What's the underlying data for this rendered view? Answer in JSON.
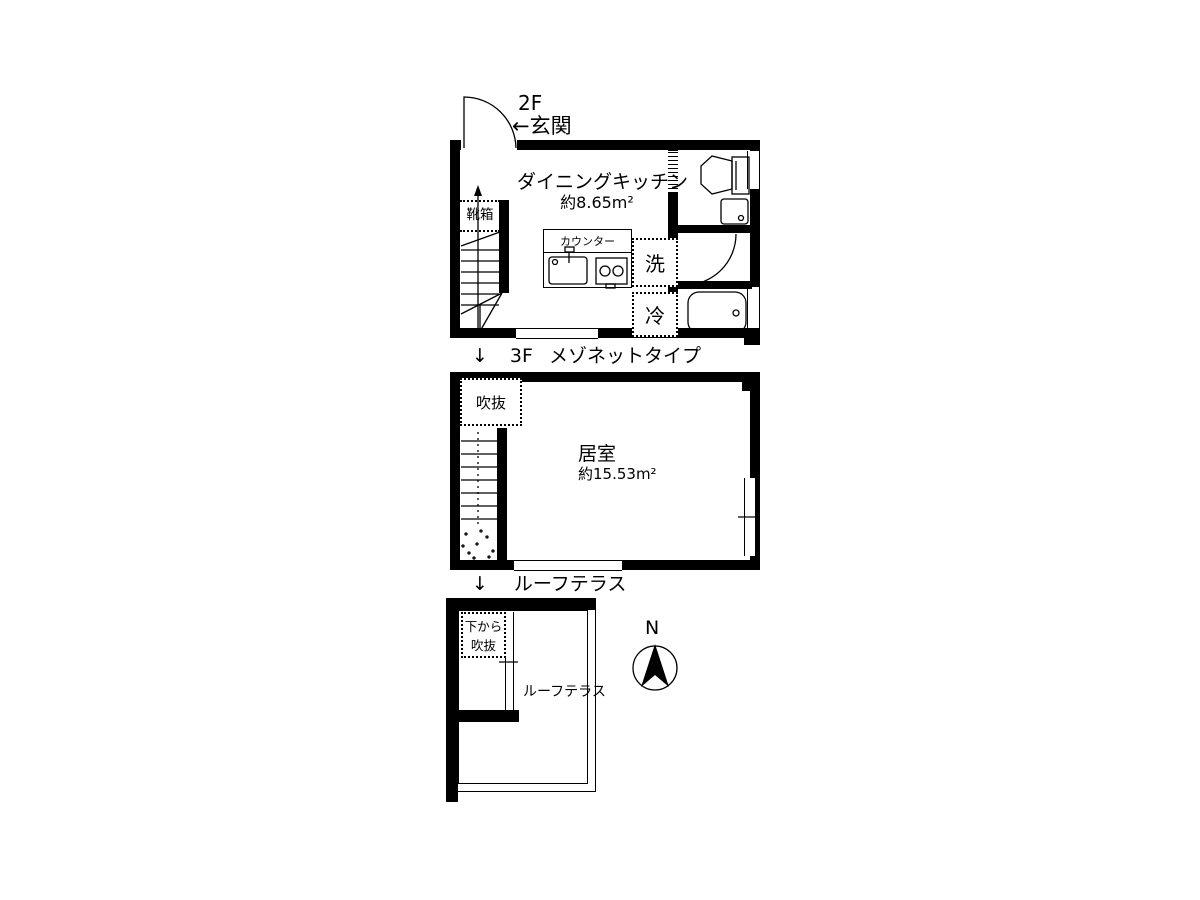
{
  "colors": {
    "ink": "#000000",
    "background": "#ffffff"
  },
  "floor2": {
    "floor_label": "2F",
    "entrance_label": "←玄関",
    "shoebox_label": "靴箱",
    "room_label": "ダイニングキッチン",
    "room_area": "約8.65m²",
    "counter_label": "カウンター",
    "washer_label": "洗",
    "fridge_label": "冷"
  },
  "floor3": {
    "down_arrow": "↓",
    "floor_label": "3F",
    "type_label": "メゾネットタイプ",
    "void_label": "吹抜",
    "room_label": "居室",
    "room_area": "約15.53m²"
  },
  "roof": {
    "down_arrow": "↓",
    "section_label": "ルーフテラス",
    "void_label_line1": "下から",
    "void_label_line2": "吹抜",
    "terrace_label": "ルーフテラス"
  },
  "compass": {
    "north_label": "N"
  }
}
